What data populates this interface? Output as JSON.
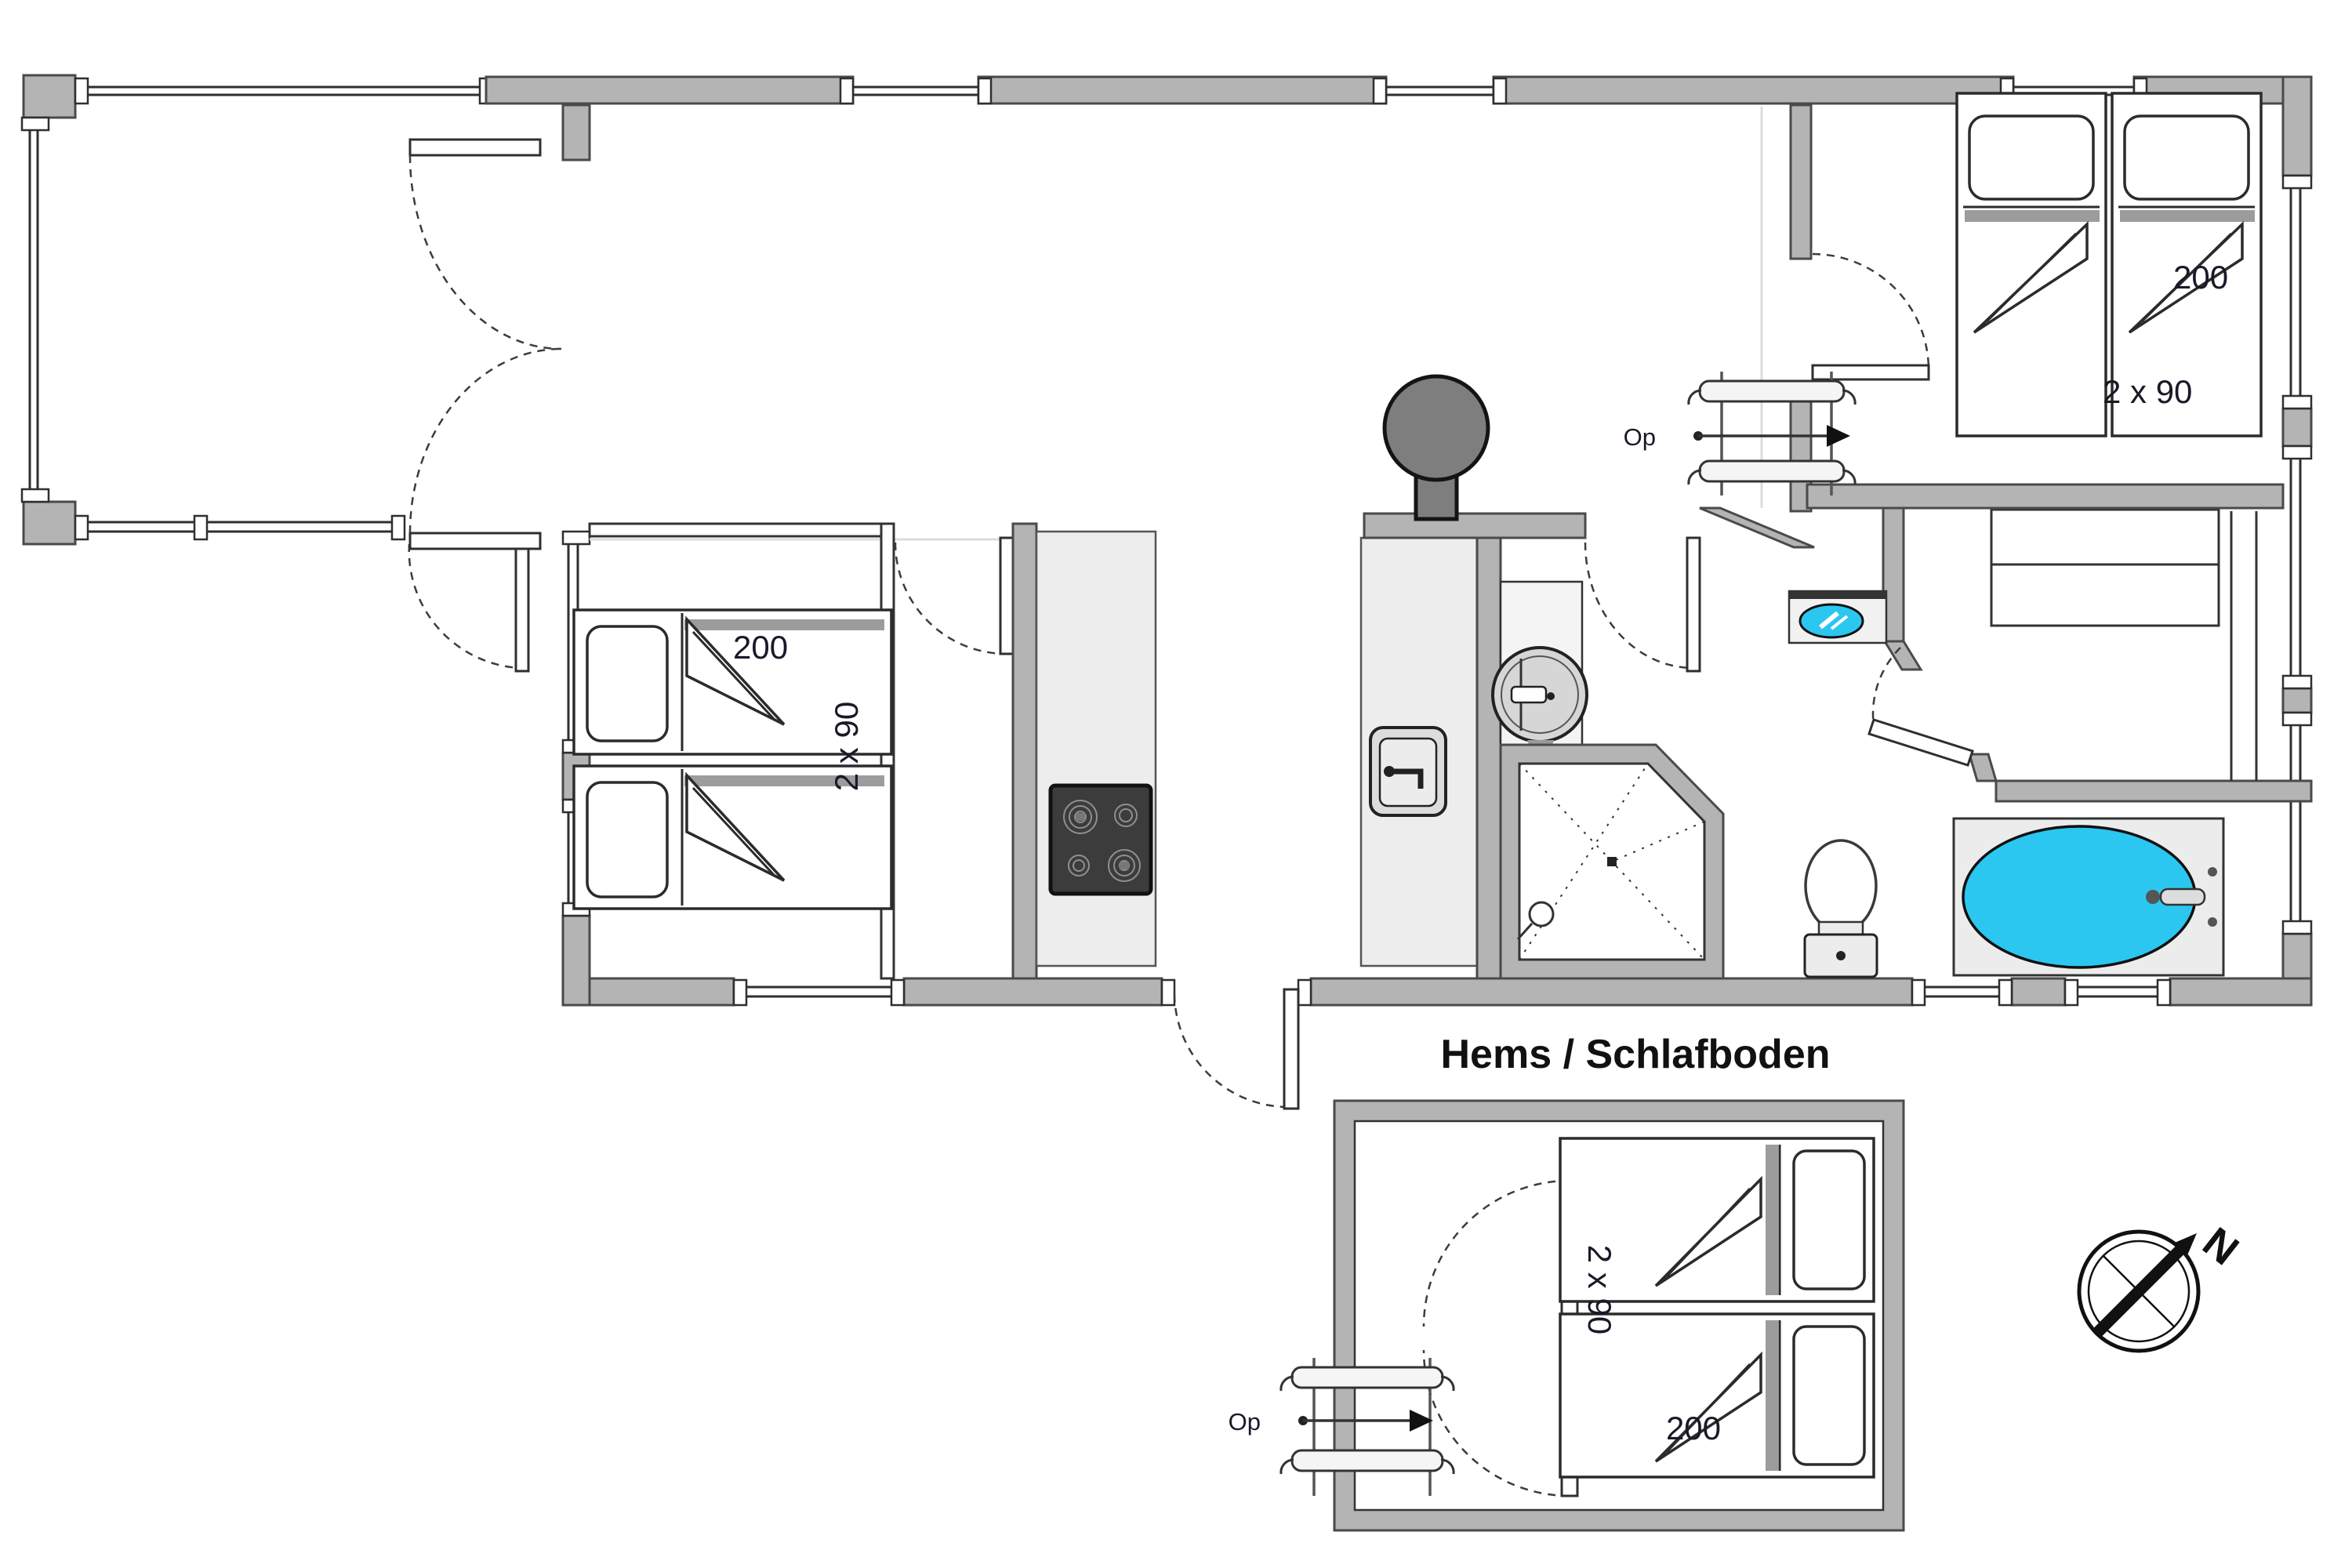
{
  "plan": {
    "type": "floor-plan",
    "loft": {
      "title": "Hems / Schlafboden",
      "length_label": "200",
      "width_label": "2 x 90"
    },
    "bedroom_left": {
      "length_label": "200",
      "width_label": "2 x 90"
    },
    "bedroom_right": {
      "length_label": "200",
      "width_label": "2 x 90"
    },
    "stairs_upper": {
      "label": "Op"
    },
    "stairs_loft": {
      "label": "Op"
    },
    "compass": {
      "north_label": "N"
    },
    "fixtures": [
      "wood-stove",
      "cooktop",
      "kitchen-sink",
      "washing-machine",
      "shower",
      "toilet",
      "bathtub",
      "washbasin",
      "wardrobe",
      "double-bed",
      "single-beds",
      "loft-ladder",
      "terrace",
      "french-doors",
      "compass"
    ]
  },
  "colors": {
    "wall": "#b4b4b4",
    "wall_edge": "#4a4a4a",
    "thin": "#333333",
    "counter": "#ededed",
    "cooktop": "#3c3c3c",
    "stove": "#7e7e7e",
    "water": "#2bc7f0",
    "fixture": "#ececec",
    "faint": "#dcdcdc",
    "text": "#191927",
    "label": "#111111"
  }
}
